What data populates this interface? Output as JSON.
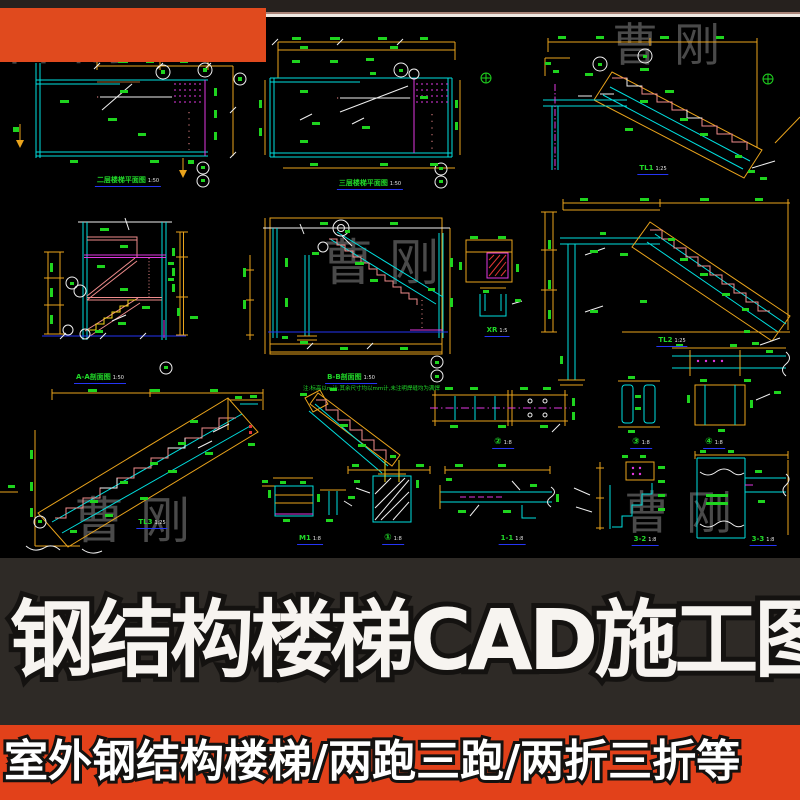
{
  "banner": {
    "title": "钢结构楼梯CAD施工图"
  },
  "footer": {
    "text": "室外钢结构楼梯/两跑三跑/两折三折等"
  },
  "watermark": {
    "text": "曹刚"
  },
  "colors": {
    "badge_orange": "#e04a1e",
    "footer_band_orange": "#e2411a",
    "title_band_dark": "#2e2a26",
    "cad_background": "#000000",
    "cad_cyan": "#00dfdf",
    "cad_yellow": "#eaa41c",
    "cad_green": "#1fd41f",
    "cad_magenta": "#e238e2",
    "cad_pink": "#ef8c8c",
    "cad_blue": "#2535f5",
    "watermark_gray": "#4a4a4a"
  },
  "cad": {
    "note": "注:标高以m计,其余尺寸均以mm计,未注明焊缝均为满焊",
    "labels": [
      {
        "id": "plan1",
        "text": "二层楼梯平面图",
        "scale": "1:50"
      },
      {
        "id": "plan2",
        "text": "三层楼梯平面图",
        "scale": "1:50"
      },
      {
        "id": "tl1",
        "text": "TL1",
        "scale": "1:25"
      },
      {
        "id": "sec-a",
        "text": "A-A剖面图",
        "scale": "1:50"
      },
      {
        "id": "sec-b",
        "text": "B-B剖面图",
        "scale": "1:50"
      },
      {
        "id": "xr",
        "text": "XR",
        "scale": "1:5"
      },
      {
        "id": "tl2",
        "text": "TL2",
        "scale": "1:25"
      },
      {
        "id": "tl3",
        "text": "TL3",
        "scale": "1:25"
      },
      {
        "id": "d1",
        "text": "①",
        "scale": "1:8"
      },
      {
        "id": "d2",
        "text": "②",
        "scale": "1:8"
      },
      {
        "id": "d3",
        "text": "③",
        "scale": "1:8"
      },
      {
        "id": "d4",
        "text": "④",
        "scale": "1:8"
      },
      {
        "id": "m1",
        "text": "M1",
        "scale": "1:8"
      },
      {
        "id": "s11",
        "text": "1-1",
        "scale": "1:8"
      },
      {
        "id": "s32",
        "text": "3-2",
        "scale": "1:8"
      },
      {
        "id": "s33",
        "text": "3-3",
        "scale": "1:8"
      }
    ]
  }
}
